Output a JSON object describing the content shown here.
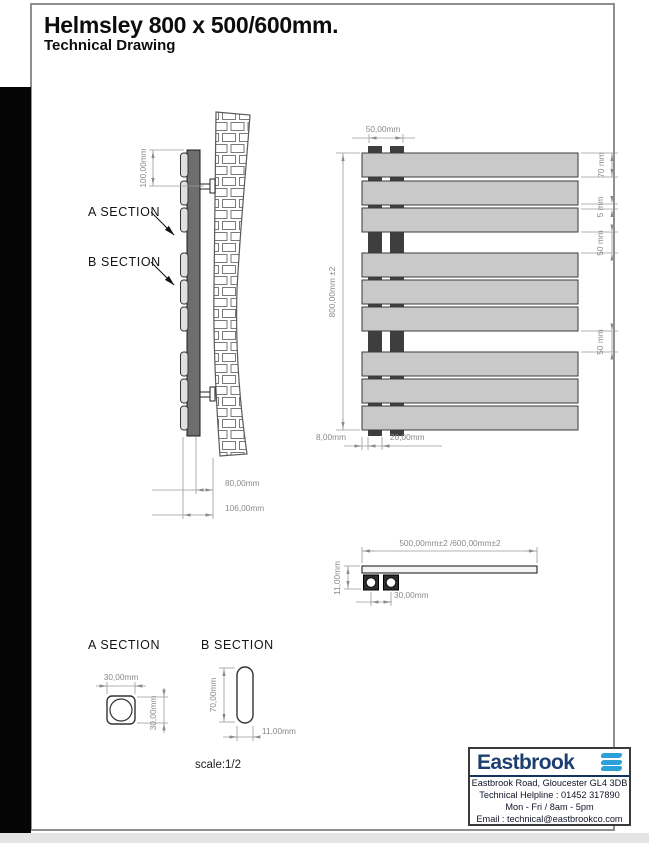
{
  "title": {
    "line1": "Helmsley 800 x 500/600mm.",
    "line2": "Technical Drawing"
  },
  "side_view": {
    "label_a": "A SECTION",
    "label_b": "B SECTION",
    "dim_top": "100,00mm",
    "dim_depth": "80,00mm",
    "dim_depth_total": "106,00mm"
  },
  "front_view": {
    "dim_tap_centres": "50,00mm",
    "dim_height": "800,00mm ±2",
    "dim_panel": "70 mm",
    "dim_gap": "5 mm",
    "dim_section1": "50 mm",
    "dim_section2": "50 mm",
    "dim_offset": "8,00mm",
    "dim_pipe_centres": "20,00mm"
  },
  "plan_view": {
    "dim_width": "500,00mm±2 /600,00mm±2",
    "dim_depth": "11,00mm",
    "dim_pipe_centres": "30,00mm"
  },
  "section_a": {
    "title": "A SECTION",
    "dim_w": "30,00mm",
    "dim_h": "30,00mm"
  },
  "section_b": {
    "title": "B SECTION",
    "dim_h": "70,00mm",
    "dim_w": "11,00mm"
  },
  "scale_label": "scale:1/2",
  "footer": {
    "brand": "Eastbrook",
    "line1": "Eastbrook Road, Gloucester GL4 3DB",
    "line2": "Technical Helpline : 01452 317890",
    "line3": "Mon - Fri / 8am - 5pm",
    "line4": "Email : technical@eastbrookco.com"
  },
  "colors": {
    "brand_navy": "#1d3f70",
    "brand_blue": "#2d9fd9",
    "panel_gray": "#c9c9c9",
    "tube_dark": "#3e3e3e",
    "dim_gray": "#8a8a8a"
  }
}
